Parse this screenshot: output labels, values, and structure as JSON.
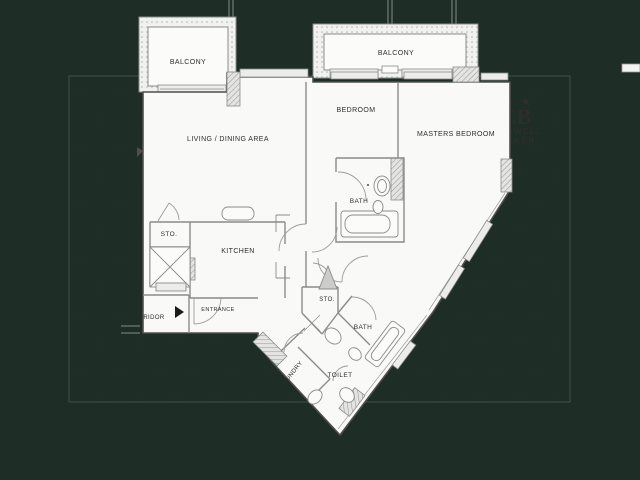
{
  "scene": {
    "background_color": "#1e2d26",
    "watermark": {
      "glyph": "CB"
    },
    "logo": {
      "star": "★",
      "monogram": "CB",
      "name_line1": "COLDWELL",
      "name_line2": "BANKER",
      "color": "#e9ede9"
    }
  },
  "floorplan": {
    "labels": {
      "balcony_left": "BALCONY",
      "balcony_right": "BALCONY",
      "living_dining": "LIVING / DINING AREA",
      "bedroom": "BEDROOM",
      "masters_bedroom": "MASTERS BEDROOM",
      "bath_master": "BATH",
      "storage_upper": "STO.",
      "kitchen": "KITCHEN",
      "entrance": "ENTRANCE",
      "corridor": "RIDOR",
      "storage_lower": "STO.",
      "bath_lower": "BATH",
      "laundry": "LAUNDRY",
      "toilet": "TOILET"
    }
  }
}
